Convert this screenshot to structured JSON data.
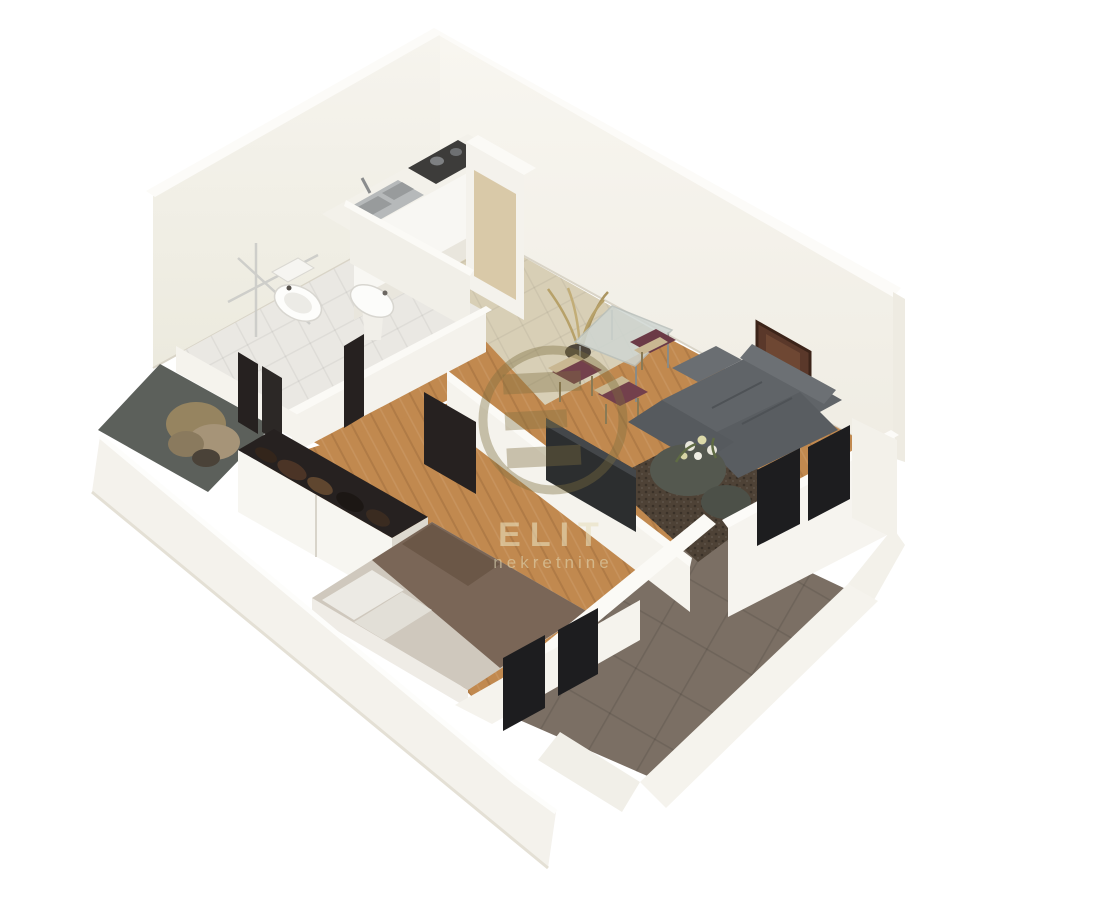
{
  "image": {
    "type": "3d-floor-plan-render",
    "style": "isometric dollhouse cutaway of a one-bedroom apartment",
    "background": "#ffffff"
  },
  "watermark": {
    "brand": "ELIT",
    "subtitle": "nekretnine",
    "logo": "circle-e-monogram",
    "ring_color": "#7d6f3f",
    "text_color": "#e8e0be"
  },
  "palette": {
    "wall_face": "#f3f1ea",
    "wall_face_light": "#f7f5ef",
    "wall_top": "#fcfbf8",
    "wall_edge": "#e6e2d8",
    "wood_floor": "#c1894f",
    "kitchen_tile": "#d8cfb6",
    "bathroom_tile": "#eae8e3",
    "balcony_floor": "#5c605b",
    "terrace_floor": "#7b6f64",
    "sofa": "#606468",
    "sofa_dark": "#53575b",
    "rug": "#4e4236",
    "chair_seat": "#73404c",
    "chair_frame": "#c9b792",
    "bed_blanket": "#7a6657",
    "bed_sheet": "#cfc8bd",
    "pillow": "#eceae4",
    "wardrobe_interior": "#262120",
    "dark_glass": "#1d1d1f",
    "painting": "#5a382a",
    "plant_dried": "#b7a169",
    "flower": "#e9e7dc",
    "leaf": "#5f6b44",
    "steel": "#b6b9ba",
    "counter_white": "#f8f7f3",
    "cabinet_beige": "#d9c9a8",
    "cooktop": "#3d3c3a"
  },
  "rooms": [
    {
      "id": "kitchen",
      "name": "kitchen"
    },
    {
      "id": "bathroom",
      "name": "bathroom"
    },
    {
      "id": "hallway",
      "name": "hallway"
    },
    {
      "id": "entry-loggia",
      "name": "entry loggia"
    },
    {
      "id": "living-dining",
      "name": "living and dining room"
    },
    {
      "id": "bedroom",
      "name": "bedroom"
    },
    {
      "id": "terrace",
      "name": "terrace"
    }
  ],
  "furniture": {
    "kitchen": [
      "l-shaped-counter",
      "sink",
      "cooktop",
      "tall-cabinet"
    ],
    "bathroom": [
      "shower",
      "toilet",
      "pedestal-basin"
    ],
    "living_dining": [
      "glass-dining-table",
      "dining-chairs",
      "dried-plant",
      "corner-sofa",
      "shag-rug",
      "pouf-with-flowers",
      "wall-painting",
      "tv-panel"
    ],
    "bedroom": [
      "double-bed",
      "pillows",
      "wardrobe",
      "tv-panel"
    ],
    "entry_loggia": [
      "potted-plant"
    ],
    "openings": [
      "living-room-windows",
      "bedroom-windows",
      "bathroom-door",
      "loggia-doors"
    ]
  }
}
